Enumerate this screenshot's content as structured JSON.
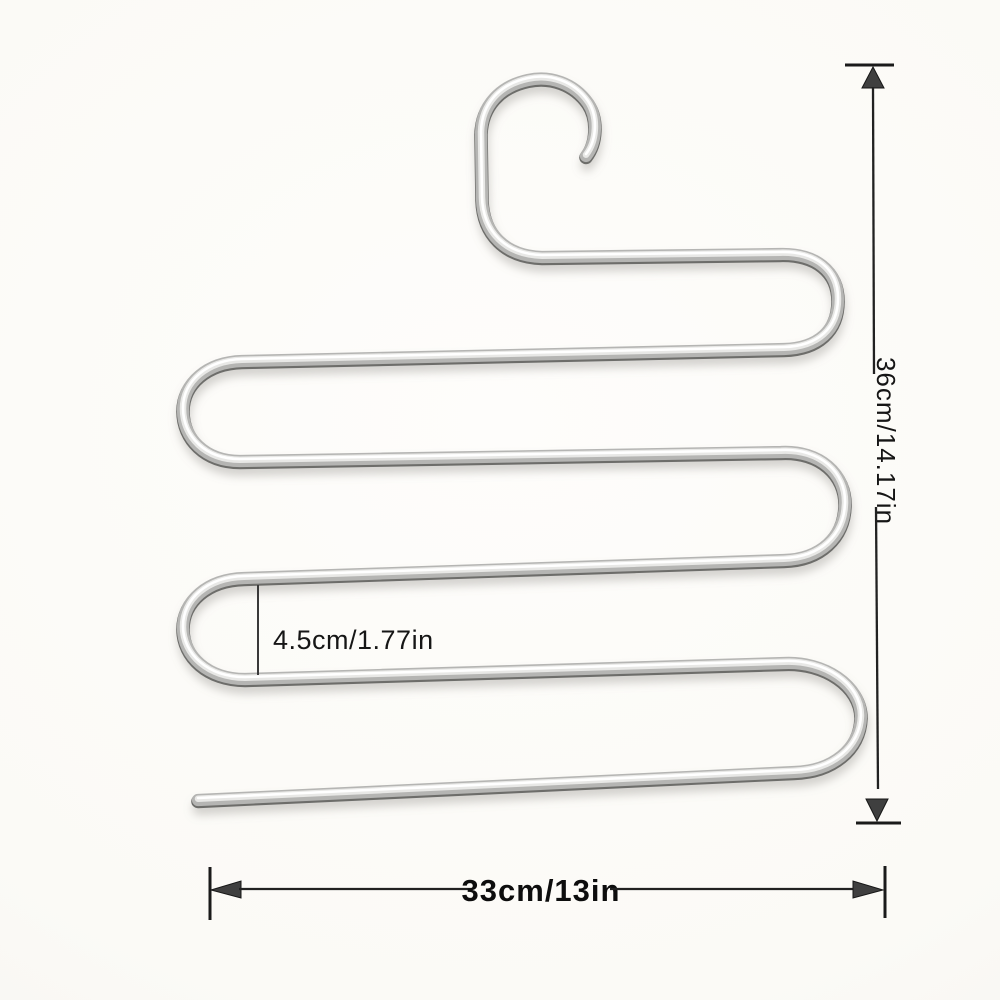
{
  "annotations": {
    "height": {
      "label": "36cm/14.17in"
    },
    "width": {
      "label": "33cm/13in"
    },
    "gap": {
      "label": "4.5cm/1.77in"
    }
  },
  "colors": {
    "background": "#fbfaf6",
    "wire_shade": "#6d6d6b",
    "wire_body": "#b5b5b3",
    "wire_light": "#e8e8e6",
    "wire_specular": "#ffffff",
    "annotation_ink": "#1a1a1a"
  }
}
